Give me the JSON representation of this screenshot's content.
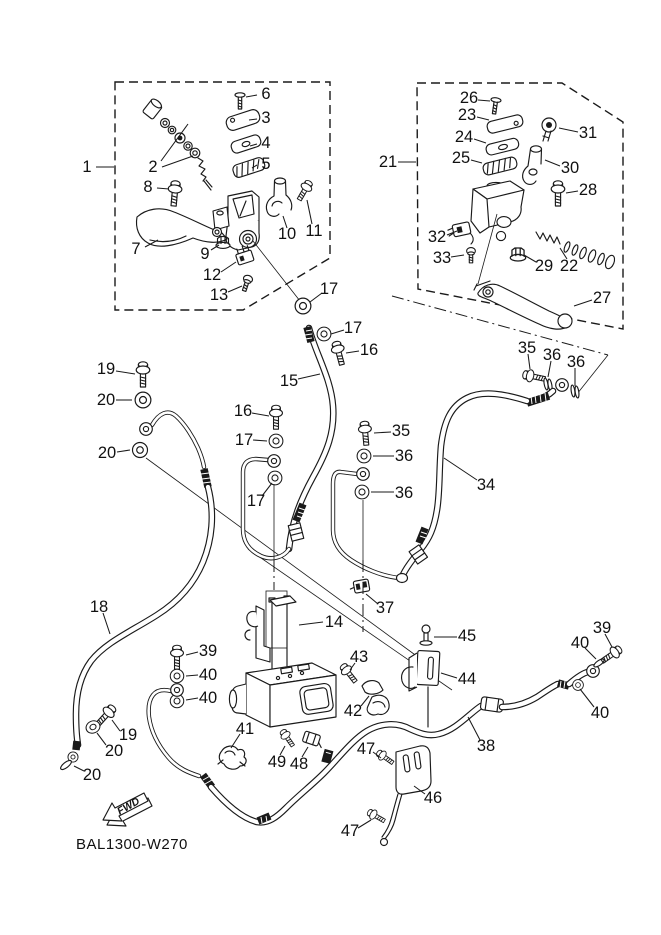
{
  "diagram": {
    "drawing_code": "BAL1300-W270",
    "fwd_label": "FWD",
    "line_color": "#1a1a1a",
    "background": "#ffffff"
  },
  "part_labels": [
    {
      "text": "1",
      "x": 87,
      "y": 167,
      "lx1": 96,
      "ly1": 167,
      "lx2": 114,
      "ly2": 167
    },
    {
      "text": "2",
      "x": 153,
      "y": 167,
      "lx1": 161,
      "ly1": 161,
      "lx2": 188,
      "ly2": 124
    },
    {
      "text": "6",
      "x": 266,
      "y": 94,
      "lx1": 257,
      "ly1": 95,
      "lx2": 246,
      "ly2": 97
    },
    {
      "text": "3",
      "x": 266,
      "y": 118,
      "lx1": 257,
      "ly1": 119,
      "lx2": 249,
      "ly2": 120
    },
    {
      "text": "4",
      "x": 266,
      "y": 143,
      "lx1": 257,
      "ly1": 144,
      "lx2": 250,
      "ly2": 146
    },
    {
      "text": "5",
      "x": 266,
      "y": 164,
      "lx1": 257,
      "ly1": 165,
      "lx2": 252,
      "ly2": 168
    },
    {
      "text": "8",
      "x": 148,
      "y": 187,
      "lx1": 157,
      "ly1": 188,
      "lx2": 169,
      "ly2": 189
    },
    {
      "text": "7",
      "x": 136,
      "y": 249,
      "lx1": 145,
      "ly1": 247,
      "lx2": 158,
      "ly2": 240
    },
    {
      "text": "9",
      "x": 205,
      "y": 254,
      "lx1": 211,
      "ly1": 250,
      "lx2": 219,
      "ly2": 245
    },
    {
      "text": "10",
      "x": 287,
      "y": 234,
      "lx1": 287,
      "ly1": 228,
      "lx2": 283,
      "ly2": 216
    },
    {
      "text": "11",
      "x": 314,
      "y": 231,
      "lx1": 312,
      "ly1": 224,
      "lx2": 307,
      "ly2": 200
    },
    {
      "text": "12",
      "x": 212,
      "y": 275,
      "lx1": 221,
      "ly1": 272,
      "lx2": 236,
      "ly2": 262
    },
    {
      "text": "13",
      "x": 219,
      "y": 295,
      "lx1": 228,
      "ly1": 292,
      "lx2": 242,
      "ly2": 286
    },
    {
      "text": "17",
      "x": 329,
      "y": 289,
      "lx1": 322,
      "ly1": 293,
      "lx2": 310,
      "ly2": 302
    },
    {
      "text": "21",
      "x": 388,
      "y": 162,
      "lx1": 398,
      "ly1": 162,
      "lx2": 416,
      "ly2": 162
    },
    {
      "text": "26",
      "x": 469,
      "y": 98,
      "lx1": 478,
      "ly1": 100,
      "lx2": 490,
      "ly2": 101
    },
    {
      "text": "23",
      "x": 467,
      "y": 115,
      "lx1": 477,
      "ly1": 117,
      "lx2": 489,
      "ly2": 120
    },
    {
      "text": "24",
      "x": 464,
      "y": 137,
      "lx1": 474,
      "ly1": 139,
      "lx2": 486,
      "ly2": 143
    },
    {
      "text": "25",
      "x": 461,
      "y": 158,
      "lx1": 471,
      "ly1": 160,
      "lx2": 482,
      "ly2": 163
    },
    {
      "text": "31",
      "x": 588,
      "y": 133,
      "lx1": 578,
      "ly1": 132,
      "lx2": 559,
      "ly2": 128
    },
    {
      "text": "30",
      "x": 570,
      "y": 168,
      "lx1": 560,
      "ly1": 166,
      "lx2": 545,
      "ly2": 160
    },
    {
      "text": "28",
      "x": 588,
      "y": 190,
      "lx1": 578,
      "ly1": 191,
      "lx2": 566,
      "ly2": 193
    },
    {
      "text": "32",
      "x": 437,
      "y": 237,
      "lx1": 447,
      "ly1": 235,
      "lx2": 457,
      "ly2": 231
    },
    {
      "text": "33",
      "x": 442,
      "y": 258,
      "lx1": 451,
      "ly1": 257,
      "lx2": 464,
      "ly2": 255
    },
    {
      "text": "29",
      "x": 544,
      "y": 266,
      "lx1": 536,
      "ly1": 262,
      "lx2": 524,
      "ly2": 255
    },
    {
      "text": "22",
      "x": 569,
      "y": 266,
      "lx1": 567,
      "ly1": 259,
      "lx2": 560,
      "ly2": 248
    },
    {
      "text": "27",
      "x": 602,
      "y": 298,
      "lx1": 592,
      "ly1": 300,
      "lx2": 574,
      "ly2": 306
    },
    {
      "text": "17",
      "x": 353,
      "y": 328,
      "lx1": 344,
      "ly1": 330,
      "lx2": 331,
      "ly2": 334
    },
    {
      "text": "16",
      "x": 369,
      "y": 350,
      "lx1": 359,
      "ly1": 351,
      "lx2": 346,
      "ly2": 353
    },
    {
      "text": "15",
      "x": 289,
      "y": 381,
      "lx1": 298,
      "ly1": 379,
      "lx2": 320,
      "ly2": 374
    },
    {
      "text": "16",
      "x": 243,
      "y": 411,
      "lx1": 252,
      "ly1": 413,
      "lx2": 269,
      "ly2": 416
    },
    {
      "text": "17",
      "x": 244,
      "y": 440,
      "lx1": 253,
      "ly1": 440,
      "lx2": 267,
      "ly2": 441
    },
    {
      "text": "17",
      "x": 256,
      "y": 501,
      "lx1": 262,
      "ly1": 496,
      "lx2": 272,
      "ly2": 483
    },
    {
      "text": "19",
      "x": 106,
      "y": 369,
      "lx1": 116,
      "ly1": 371,
      "lx2": 135,
      "ly2": 374
    },
    {
      "text": "20",
      "x": 106,
      "y": 400,
      "lx1": 116,
      "ly1": 400,
      "lx2": 132,
      "ly2": 400
    },
    {
      "text": "20",
      "x": 107,
      "y": 453,
      "lx1": 117,
      "ly1": 452,
      "lx2": 130,
      "ly2": 450
    },
    {
      "text": "35",
      "x": 401,
      "y": 431,
      "lx1": 391,
      "ly1": 432,
      "lx2": 374,
      "ly2": 433
    },
    {
      "text": "36",
      "x": 404,
      "y": 456,
      "lx1": 394,
      "ly1": 456,
      "lx2": 373,
      "ly2": 456
    },
    {
      "text": "36",
      "x": 404,
      "y": 493,
      "lx1": 394,
      "ly1": 492,
      "lx2": 371,
      "ly2": 492
    },
    {
      "text": "35",
      "x": 527,
      "y": 348,
      "lx1": 528,
      "ly1": 354,
      "lx2": 530,
      "ly2": 369
    },
    {
      "text": "36",
      "x": 552,
      "y": 355,
      "lx1": 551,
      "ly1": 361,
      "lx2": 548,
      "ly2": 377
    },
    {
      "text": "36",
      "x": 576,
      "y": 362,
      "lx1": 575,
      "ly1": 368,
      "lx2": 575,
      "ly2": 386
    },
    {
      "text": "34",
      "x": 486,
      "y": 485,
      "lx1": 477,
      "ly1": 480,
      "lx2": 444,
      "ly2": 458
    },
    {
      "text": "37",
      "x": 385,
      "y": 608,
      "lx1": 378,
      "ly1": 604,
      "lx2": 366,
      "ly2": 594
    },
    {
      "text": "18",
      "x": 99,
      "y": 607,
      "lx1": 103,
      "ly1": 613,
      "lx2": 110,
      "ly2": 634
    },
    {
      "text": "14",
      "x": 334,
      "y": 622,
      "lx1": 323,
      "ly1": 622,
      "lx2": 299,
      "ly2": 625
    },
    {
      "text": "39",
      "x": 208,
      "y": 651,
      "lx1": 198,
      "ly1": 652,
      "lx2": 186,
      "ly2": 655
    },
    {
      "text": "40",
      "x": 208,
      "y": 675,
      "lx1": 198,
      "ly1": 675,
      "lx2": 186,
      "ly2": 676
    },
    {
      "text": "40",
      "x": 208,
      "y": 698,
      "lx1": 198,
      "ly1": 698,
      "lx2": 186,
      "ly2": 700
    },
    {
      "text": "19",
      "x": 128,
      "y": 735,
      "lx1": 120,
      "ly1": 731,
      "lx2": 112,
      "ly2": 720
    },
    {
      "text": "20",
      "x": 114,
      "y": 751,
      "lx1": 106,
      "ly1": 745,
      "lx2": 97,
      "ly2": 733
    },
    {
      "text": "20",
      "x": 92,
      "y": 775,
      "lx1": 84,
      "ly1": 771,
      "lx2": 74,
      "ly2": 766
    },
    {
      "text": "41",
      "x": 245,
      "y": 729,
      "lx1": 240,
      "ly1": 734,
      "lx2": 231,
      "ly2": 748
    },
    {
      "text": "49",
      "x": 277,
      "y": 762,
      "lx1": 280,
      "ly1": 755,
      "lx2": 285,
      "ly2": 746
    },
    {
      "text": "48",
      "x": 299,
      "y": 764,
      "lx1": 302,
      "ly1": 757,
      "lx2": 308,
      "ly2": 747
    },
    {
      "text": "43",
      "x": 359,
      "y": 657,
      "lx1": 355,
      "ly1": 663,
      "lx2": 350,
      "ly2": 670
    },
    {
      "text": "42",
      "x": 353,
      "y": 711,
      "lx1": 361,
      "ly1": 706,
      "lx2": 369,
      "ly2": 696
    },
    {
      "text": "45",
      "x": 467,
      "y": 636,
      "lx1": 457,
      "ly1": 637,
      "lx2": 434,
      "ly2": 637
    },
    {
      "text": "44",
      "x": 467,
      "y": 679,
      "lx1": 457,
      "ly1": 678,
      "lx2": 441,
      "ly2": 673
    },
    {
      "text": "39",
      "x": 602,
      "y": 628,
      "lx1": 605,
      "ly1": 634,
      "lx2": 612,
      "ly2": 647
    },
    {
      "text": "40",
      "x": 580,
      "y": 643,
      "lx1": 585,
      "ly1": 648,
      "lx2": 596,
      "ly2": 659
    },
    {
      "text": "40",
      "x": 600,
      "y": 713,
      "lx1": 594,
      "ly1": 707,
      "lx2": 580,
      "ly2": 689
    },
    {
      "text": "38",
      "x": 486,
      "y": 746,
      "lx1": 480,
      "ly1": 740,
      "lx2": 468,
      "ly2": 717
    },
    {
      "text": "46",
      "x": 433,
      "y": 798,
      "lx1": 425,
      "ly1": 794,
      "lx2": 414,
      "ly2": 786
    },
    {
      "text": "47",
      "x": 366,
      "y": 749,
      "lx1": 373,
      "ly1": 752,
      "lx2": 381,
      "ly2": 758
    },
    {
      "text": "47",
      "x": 350,
      "y": 831,
      "lx1": 358,
      "ly1": 828,
      "lx2": 371,
      "ly2": 820
    }
  ],
  "extra_leaders": [
    [
      162,
      167,
      193,
      156
    ]
  ]
}
